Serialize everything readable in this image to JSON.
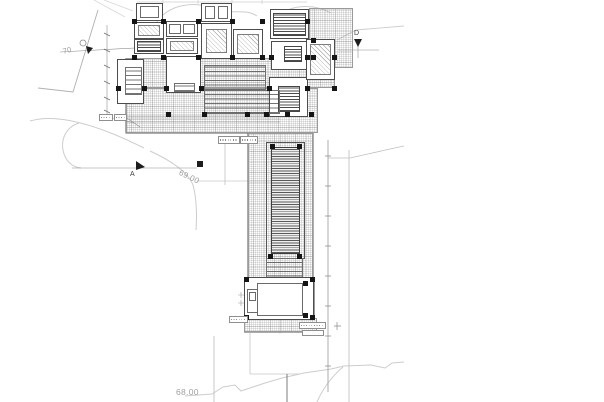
{
  "canvas": {
    "width": 604,
    "height": 402,
    "background": "#ffffff"
  },
  "palette": {
    "line_dark": "#3f3f3f",
    "line_mid": "#8a8a8a",
    "line_light": "#cdcdcd",
    "marker_fill": "#1d1d1d"
  },
  "labels": [
    {
      "name": "contour-label-69",
      "text": "69.00",
      "x": 181,
      "y": 169,
      "rot": 26,
      "size": 8,
      "color": "#9b9b9b"
    },
    {
      "name": "contour-label-68",
      "text": "68.00",
      "x": 176,
      "y": 388,
      "rot": 0,
      "size": 8.5,
      "color": "#a0a0a0"
    },
    {
      "name": "contour-label-70",
      "text": "70",
      "x": 62,
      "y": 48,
      "rot": -14,
      "size": 7.5,
      "color": "#9b9b9b"
    },
    {
      "name": "section-marker-a-label",
      "text": "A",
      "x": 130,
      "y": 171,
      "rot": 0,
      "size": 7,
      "color": "#3f3f3f"
    },
    {
      "name": "section-marker-d-label",
      "text": "D",
      "x": 354,
      "y": 30,
      "rot": 0,
      "size": 7,
      "color": "#3f3f3f"
    }
  ],
  "areas": [
    {
      "name": "upper-terrace-deck",
      "x": 309,
      "y": 8,
      "w": 44,
      "h": 60,
      "cls": "grid"
    },
    {
      "name": "main-deck-upper",
      "x": 126,
      "y": 58,
      "w": 209,
      "h": 30,
      "cls": "grid"
    },
    {
      "name": "main-deck-lower",
      "x": 126,
      "y": 88,
      "w": 192,
      "h": 45,
      "cls": "grid"
    },
    {
      "name": "pool-corridor-deck",
      "x": 248,
      "y": 133,
      "w": 65,
      "h": 150,
      "cls": "grid"
    },
    {
      "name": "pavilion-south-deck",
      "x": 244,
      "y": 318,
      "w": 73,
      "h": 14,
      "cls": "grid"
    },
    {
      "name": "pavilion-east-band",
      "x": 303,
      "y": 279,
      "w": 12,
      "h": 40,
      "cls": "grid"
    },
    {
      "name": "room-nw-1",
      "x": 136,
      "y": 3,
      "w": 27,
      "h": 18,
      "cls": "room"
    },
    {
      "name": "room-nw-1-inner",
      "x": 140,
      "y": 6,
      "w": 19,
      "h": 12,
      "cls": "out"
    },
    {
      "name": "room-nw-2",
      "x": 134,
      "y": 22,
      "w": 30,
      "h": 17,
      "cls": "room"
    },
    {
      "name": "room-nw-2-inner",
      "x": 138,
      "y": 25,
      "w": 22,
      "h": 11,
      "cls": "diag"
    },
    {
      "name": "room-nw-3",
      "x": 134,
      "y": 39,
      "w": 30,
      "h": 15,
      "cls": "room"
    },
    {
      "name": "room-nw-3-inner",
      "x": 137,
      "y": 41,
      "w": 24,
      "h": 11,
      "cls": "hdark"
    },
    {
      "name": "room-n-closets",
      "x": 166,
      "y": 21,
      "w": 32,
      "h": 16,
      "cls": "room"
    },
    {
      "name": "closet-1",
      "x": 169,
      "y": 24,
      "w": 12,
      "h": 10,
      "cls": "out"
    },
    {
      "name": "closet-2",
      "x": 183,
      "y": 24,
      "w": 12,
      "h": 10,
      "cls": "out"
    },
    {
      "name": "room-n-2",
      "x": 166,
      "y": 38,
      "w": 32,
      "h": 16,
      "cls": "room"
    },
    {
      "name": "room-n-2-inner",
      "x": 170,
      "y": 41,
      "w": 24,
      "h": 10,
      "cls": "diag"
    },
    {
      "name": "room-nc-1",
      "x": 201,
      "y": 3,
      "w": 31,
      "h": 19,
      "cls": "room"
    },
    {
      "name": "room-nc-1-inner-a",
      "x": 205,
      "y": 6,
      "w": 10,
      "h": 13,
      "cls": "out"
    },
    {
      "name": "room-nc-1-inner-b",
      "x": 218,
      "y": 6,
      "w": 10,
      "h": 13,
      "cls": "out"
    },
    {
      "name": "room-center-1",
      "x": 201,
      "y": 23,
      "w": 31,
      "h": 36,
      "cls": "room"
    },
    {
      "name": "room-center-1-inner",
      "x": 206,
      "y": 29,
      "w": 21,
      "h": 24,
      "cls": "diag"
    },
    {
      "name": "room-center-2",
      "x": 233,
      "y": 29,
      "w": 30,
      "h": 30,
      "cls": "room"
    },
    {
      "name": "room-center-2-inner",
      "x": 237,
      "y": 34,
      "w": 22,
      "h": 20,
      "cls": "diag"
    },
    {
      "name": "louver-block-ne",
      "x": 270,
      "y": 9,
      "w": 39,
      "h": 30,
      "cls": "room"
    },
    {
      "name": "louver-block-ne-inner",
      "x": 273,
      "y": 13,
      "w": 33,
      "h": 23,
      "cls": "hdark"
    },
    {
      "name": "room-e-1",
      "x": 271,
      "y": 41,
      "w": 37,
      "h": 29,
      "cls": "room"
    },
    {
      "name": "room-e-1-inner",
      "x": 284,
      "y": 46,
      "w": 18,
      "h": 16,
      "cls": "hdark"
    },
    {
      "name": "room-e-2",
      "x": 269,
      "y": 77,
      "w": 39,
      "h": 40,
      "cls": "room"
    },
    {
      "name": "room-e-2-inner",
      "x": 278,
      "y": 86,
      "w": 22,
      "h": 26,
      "cls": "hdark"
    },
    {
      "name": "room-e-wing",
      "x": 306,
      "y": 39,
      "w": 29,
      "h": 41,
      "cls": "room"
    },
    {
      "name": "room-e-wing-inner",
      "x": 310,
      "y": 44,
      "w": 21,
      "h": 31,
      "cls": "diag"
    },
    {
      "name": "room-w-wing",
      "x": 117,
      "y": 59,
      "w": 27,
      "h": 45,
      "cls": "room"
    },
    {
      "name": "room-w-wing-inner",
      "x": 125,
      "y": 67,
      "w": 17,
      "h": 28,
      "cls": "hmed"
    },
    {
      "name": "court-room",
      "x": 166,
      "y": 56,
      "w": 35,
      "h": 37,
      "cls": "room"
    },
    {
      "name": "court-room-band",
      "x": 174,
      "y": 83,
      "w": 21,
      "h": 9,
      "cls": "hmed"
    },
    {
      "name": "central-steps-upper",
      "x": 204,
      "y": 65,
      "w": 62,
      "h": 26,
      "cls": "hmed"
    },
    {
      "name": "central-steps-lower",
      "x": 204,
      "y": 90,
      "w": 76,
      "h": 24,
      "cls": "hmed"
    },
    {
      "name": "pool-outer",
      "x": 266,
      "y": 142,
      "w": 39,
      "h": 117,
      "cls": "out2"
    },
    {
      "name": "reflecting-pool",
      "x": 271,
      "y": 147,
      "w": 29,
      "h": 107,
      "cls": "hdark2"
    },
    {
      "name": "pool-steps",
      "x": 266,
      "y": 258,
      "w": 37,
      "h": 24,
      "cls": "hmed"
    },
    {
      "name": "pavilion",
      "x": 244,
      "y": 277,
      "w": 70,
      "h": 43,
      "cls": "room"
    },
    {
      "name": "pavilion-inner",
      "x": 257,
      "y": 283,
      "w": 46,
      "h": 33,
      "cls": "out"
    },
    {
      "name": "pavilion-room-w",
      "x": 247,
      "y": 289,
      "w": 11,
      "h": 24,
      "cls": "out"
    },
    {
      "name": "pavilion-room-w-inner",
      "x": 249,
      "y": 292,
      "w": 7,
      "h": 9,
      "cls": "out"
    }
  ],
  "columns": [
    [
      134,
      21
    ],
    [
      163,
      21
    ],
    [
      198,
      21
    ],
    [
      232,
      21
    ],
    [
      262,
      21
    ],
    [
      307,
      21
    ],
    [
      134,
      57
    ],
    [
      163,
      57
    ],
    [
      198,
      57
    ],
    [
      232,
      57
    ],
    [
      262,
      57
    ],
    [
      271,
      57
    ],
    [
      307,
      57
    ],
    [
      313,
      57
    ],
    [
      334,
      57
    ],
    [
      118,
      88
    ],
    [
      144,
      88
    ],
    [
      166,
      88
    ],
    [
      201,
      88
    ],
    [
      269,
      88
    ],
    [
      307,
      88
    ],
    [
      334,
      88
    ],
    [
      168,
      114
    ],
    [
      204,
      114
    ],
    [
      247,
      114
    ],
    [
      266,
      114
    ],
    [
      287,
      114
    ],
    [
      311,
      114
    ],
    [
      313,
      40
    ],
    [
      272,
      146
    ],
    [
      299,
      146
    ],
    [
      270,
      256
    ],
    [
      299,
      256
    ],
    [
      246,
      279
    ],
    [
      312,
      279
    ],
    [
      246,
      317
    ],
    [
      312,
      317
    ],
    [
      305,
      283
    ],
    [
      305,
      315
    ]
  ],
  "tags": [
    {
      "name": "elevation-tag-1",
      "x": 99,
      "y": 114,
      "w": 14,
      "h": 7
    },
    {
      "name": "elevation-tag-2",
      "x": 114,
      "y": 114,
      "w": 13,
      "h": 7
    },
    {
      "name": "elevation-tag-3",
      "x": 218,
      "y": 136,
      "w": 22,
      "h": 8
    },
    {
      "name": "elevation-tag-4",
      "x": 240,
      "y": 136,
      "w": 18,
      "h": 8
    },
    {
      "name": "elevation-tag-5",
      "x": 229,
      "y": 316,
      "w": 19,
      "h": 7
    },
    {
      "name": "elevation-tag-6",
      "x": 299,
      "y": 322,
      "w": 27,
      "h": 7
    },
    {
      "name": "elevation-tag-7",
      "x": 302,
      "y": 330,
      "w": 22,
      "h": 6
    }
  ],
  "svg": {
    "paths": [
      {
        "name": "top-dim-line",
        "d": "M137 2 L307 2 M163 0 L163 4 M198 0 L198 4 M232 0 L232 4 M262 0 L262 4",
        "stroke": "#cfcfcf",
        "w": 0.7
      },
      {
        "name": "boundary-nw",
        "d": "M98 10 L73 92 L38 88",
        "stroke": "#b0b0b0",
        "w": 0.9
      },
      {
        "name": "terrain-blob-1",
        "d": "M157 22 C168 5 194 0 213 9 C227 16 243 7 257 16",
        "stroke": "#cdcdcd",
        "w": 1
      },
      {
        "name": "terrain-blob-2",
        "d": "M280 15 C293 4 315 4 331 13",
        "stroke": "#cdcdcd",
        "w": 1
      },
      {
        "name": "nw-diag-1",
        "d": "M94 0 L125 17",
        "stroke": "#d8d8d8",
        "w": 0.8
      },
      {
        "name": "nw-diag-2",
        "d": "M104 0 L133 11",
        "stroke": "#d8d8d8",
        "w": 0.8
      },
      {
        "name": "terrain-ne",
        "d": "M337 40 L356 30 L404 26",
        "stroke": "#cdcdcd",
        "w": 0.9
      },
      {
        "name": "contour-west",
        "d": "M30 121 C60 112 104 128 144 148",
        "stroke": "#cdcdcd",
        "w": 1
      },
      {
        "name": "contour-hook",
        "d": "M79 123 C66 127 61 139 63 150 C65 161 72 167 81 168",
        "stroke": "#cdcdcd",
        "w": 1
      },
      {
        "name": "contour-69",
        "d": "M150 151 C170 160 188 172 193 185 C197 200 197 215 196 230",
        "stroke": "#cdcdcd",
        "w": 1
      },
      {
        "name": "contour-68",
        "d": "M185 396 L212 394 L223 387 L235 385 L241 391 L250 388 L265 383 L282 378 L304 373 L331 369 L344 366 L371 365 L385 368 L392 363 L404 362",
        "stroke": "#cdcdcd",
        "w": 1
      },
      {
        "name": "contour-68-branch",
        "d": "M317 402 C322 390 332 376 343 367",
        "stroke": "#cdcdcd",
        "w": 1
      },
      {
        "name": "leader-east",
        "d": "M328 158 L350 158 C368 154 385 150 404 146",
        "stroke": "#c0c0c0",
        "w": 0.8
      },
      {
        "name": "axis-g",
        "d": "M60 52 L153 47",
        "stroke": "#8f8f8f",
        "w": 0.6
      },
      {
        "name": "section-line-a",
        "d": "M72 168 L197 168",
        "stroke": "#8f8f8f",
        "w": 0.6
      },
      {
        "name": "marker-d-tail",
        "d": "M358 43 L358 58 M338 50 L379 50",
        "stroke": "#8f8f8f",
        "w": 0.6
      },
      {
        "name": "dim-chain-west",
        "d": "M107 25 L107 114",
        "stroke": "#8f8f8f",
        "w": 0.6
      },
      {
        "name": "dim-chain-west-ticks",
        "d": "M104 33 L110 36 M104 49 L110 52 M104 65 L110 68 M104 81 L110 84 M104 97 L110 100 M104 110 L110 113",
        "stroke": "#6f6f6f",
        "w": 0.7
      },
      {
        "name": "dim-line-mid",
        "d": "M225 143 L225 185 M197 181 L271 181",
        "stroke": "#b0b0b0",
        "w": 0.6
      },
      {
        "name": "pool-axis",
        "d": "M280 133 L280 334",
        "stroke": "#c4c4c4",
        "w": 0.5
      },
      {
        "name": "boundary-east",
        "d": "M328 140 L328 392",
        "stroke": "#9a9a9a",
        "w": 0.8
      },
      {
        "name": "boundary-east-ticks",
        "d": "M325 156 L331 156 M325 186 L331 186 M325 216 L331 216 M325 246 L331 246 M325 276 L331 276 M325 306 L331 306 M325 336 L331 336 M325 366 L331 366",
        "stroke": "#8a8a8a",
        "w": 0.7
      },
      {
        "name": "line-east-2",
        "d": "M349 150 L349 402",
        "stroke": "#bdbdbd",
        "w": 0.8
      },
      {
        "name": "line-south-1",
        "d": "M214 336 L214 402",
        "stroke": "#bdbdbd",
        "w": 0.8
      },
      {
        "name": "line-south-2",
        "d": "M250 333 L250 374 M250 374 L299 374",
        "stroke": "#c6c6c6",
        "w": 0.8
      },
      {
        "name": "line-south-3",
        "d": "M287 374 L287 402",
        "stroke": "#6e6e6e",
        "w": 0.9
      },
      {
        "name": "building-edges",
        "d": "M126 58 L126 133 L313 133 M248 133 L248 277 M313 133 L313 277 M244 332 L317 332",
        "stroke": "#5a5a5a",
        "w": 1
      },
      {
        "name": "deck-step-lines",
        "d": "M126 116 L280 116 M126 119 L280 119 M126 122 L280 122",
        "stroke": "#9f9f9f",
        "w": 0.5
      },
      {
        "name": "court-room-cross",
        "d": "M166 56 L201 93 M201 56 L166 93",
        "stroke": "#9a9a9a",
        "w": 0.5
      },
      {
        "name": "pavilion-cross",
        "d": "M261 287 L299 313 M299 287 L261 313",
        "stroke": "#8a8a8a",
        "w": 0.5
      },
      {
        "name": "tag-leader-1",
        "d": "M113 118 L134 123",
        "stroke": "#9a9a9a",
        "w": 0.6
      },
      {
        "name": "tag-leader-2",
        "d": "M127 118 L140 127",
        "stroke": "#9a9a9a",
        "w": 0.6
      },
      {
        "name": "tag-leader-5",
        "d": "M248 319 L258 317",
        "stroke": "#9a9a9a",
        "w": 0.6
      },
      {
        "name": "cross-tick-se",
        "d": "M334 326 L341 326 M337 322 L337 330",
        "stroke": "#8a8a8a",
        "w": 0.7
      },
      {
        "name": "plus-marks-pavilion",
        "d": "M238 295 L244 295 M241 292 L241 298 M238 303 L244 303 M241 300 L241 306",
        "stroke": "#9a9a9a",
        "w": 0.6
      }
    ],
    "circles": [
      {
        "name": "grid-bubble-g",
        "cx": 83,
        "cy": 43,
        "r": 3,
        "stroke": "#8a8a8a"
      },
      {
        "name": "pavilion-motif-outer",
        "cx": 280,
        "cy": 300,
        "r": 7,
        "stroke": "#6f6f6f"
      },
      {
        "name": "pavilion-motif-inner",
        "cx": 280,
        "cy": 300,
        "r": 3,
        "stroke": "#6f6f6f"
      }
    ],
    "polys": [
      {
        "name": "arrow-g",
        "points": "86,46 93,48 88,54",
        "fill": "#1d1d1d"
      },
      {
        "name": "arrow-section-a",
        "points": "136,161 145,167 136,170",
        "fill": "#1d1d1d"
      },
      {
        "name": "arrow-section-d",
        "points": "354,39 362,39 358,47",
        "fill": "#1d1d1d"
      },
      {
        "name": "dim-node",
        "points": "197,161 203,161 203,167 197,167",
        "fill": "#1d1d1d"
      }
    ]
  }
}
